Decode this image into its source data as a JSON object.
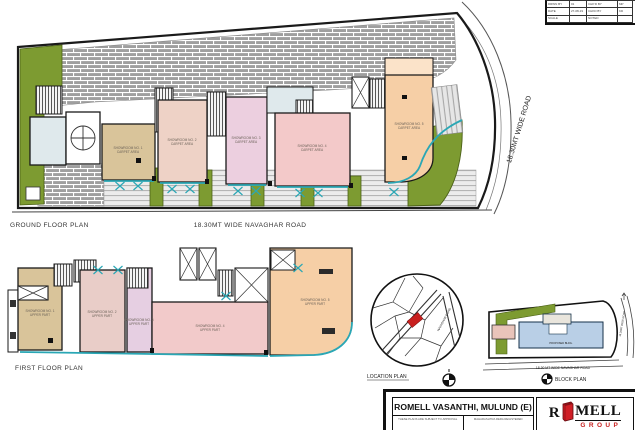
{
  "ground_floor": {
    "label": "GROUND FLOOR PLAN",
    "road_label": "18.30MT WIDE NAVAGHAR ROAD",
    "side_road_label": "18.30MT WIDE ROAD",
    "units": [
      {
        "name": "SHOWROOM NO. 1",
        "sub": "CARPET AREA"
      },
      {
        "name": "SHOWROOM NO. 2",
        "sub": "CARPET AREA"
      },
      {
        "name": "SHOWROOM NO. 3",
        "sub": "CARPET AREA"
      },
      {
        "name": "SHOWROOM NO. 4",
        "sub": "CARPET AREA"
      },
      {
        "name": "SHOWROOM NO. 5",
        "sub": "CARPET AREA"
      }
    ]
  },
  "first_floor": {
    "label": "FIRST FLOOR PLAN",
    "units": [
      {
        "name": "SHOWROOM NO. 1",
        "sub": "UPPER PART"
      },
      {
        "name": "SHOWROOM NO. 2",
        "sub": "UPPER PART"
      },
      {
        "name": "SHOWROOM NO. 3",
        "sub": "UPPER PART"
      },
      {
        "name": "SHOWROOM NO. 4",
        "sub": "UPPER PART"
      },
      {
        "name": "SHOWROOM NO. 5",
        "sub": "UPPER PART"
      }
    ]
  },
  "location_plan": {
    "label": "LOCATION PLAN",
    "road_label": "NAVAGHAR ROAD"
  },
  "block_plan": {
    "label": "BLOCK PLAN",
    "building_label": "PROPOSED BLDG.",
    "road_label": "18.30 MT WIDE NAVAGHAR ROAD",
    "side_road_label": "18.30MT WIDE ROAD"
  },
  "title_block": {
    "project": "ROMELL VASANTHI, MULUND (E)",
    "note_left": "THESE PLANS ARE SUBJECT TO APPROVAL",
    "note_right": "MAHARASHTRA RERA REGISTERED",
    "logo": {
      "prefix": "R",
      "suffix": "MELL",
      "line2": "GROUP"
    }
  },
  "revision_table": {
    "rows": [
      [
        "DRWN BY",
        "01",
        "CHK'D BY",
        "MP"
      ],
      [
        "DATE",
        "27-08-19",
        "CHKD BY",
        "KD"
      ],
      [
        "SCALE",
        "",
        "NOTED",
        ""
      ]
    ]
  },
  "colors": {
    "green": "#7d9b31",
    "teal": "#2aa7b5",
    "red": "#c8201f",
    "brick_grey": "#9f9f9f",
    "blue_building": "#b9cfe6"
  }
}
